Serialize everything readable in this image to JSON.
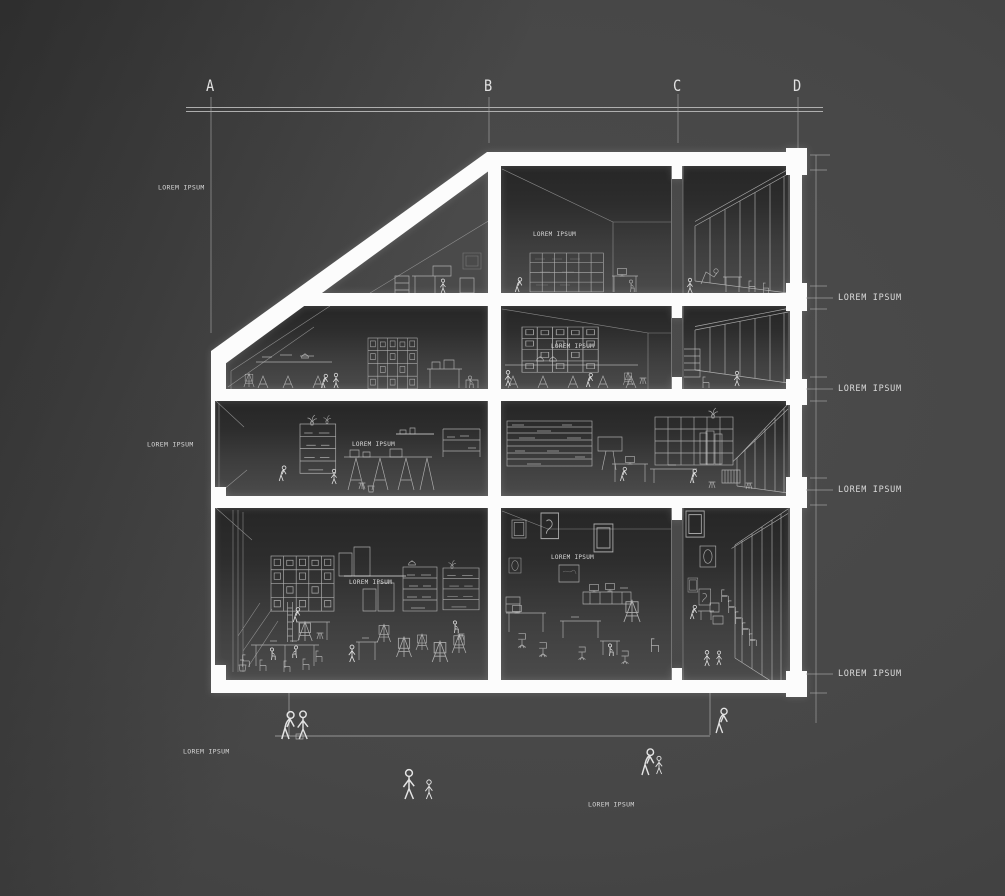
{
  "colors": {
    "background": "#4c4c4c",
    "structure": "#fcfcfc",
    "linework": "#c9c9c9",
    "text": "#d6d6d6"
  },
  "grid": {
    "letters": [
      "A",
      "B",
      "C",
      "D"
    ]
  },
  "annotations": {
    "left_labels": [
      {
        "text": "LOREM IPSUM"
      },
      {
        "text": "LOREM IPSUM"
      }
    ],
    "level_labels": [
      {
        "text": "LOREM IPSUM"
      },
      {
        "text": "LOREM IPSUM"
      },
      {
        "text": "LOREM IPSUM"
      },
      {
        "text": "LOREM IPSUM"
      }
    ],
    "room_labels": [
      {
        "text": "LOREM IPSUM"
      },
      {
        "text": "LOREM IPSUM"
      },
      {
        "text": "LOREM IPSUM"
      },
      {
        "text": "LOREM IPSUM"
      },
      {
        "text": "LOREM IPSUM"
      }
    ],
    "bottom_labels": [
      {
        "text": "LOREM IPSUM"
      },
      {
        "text": "LOREM IPSUM"
      }
    ]
  }
}
